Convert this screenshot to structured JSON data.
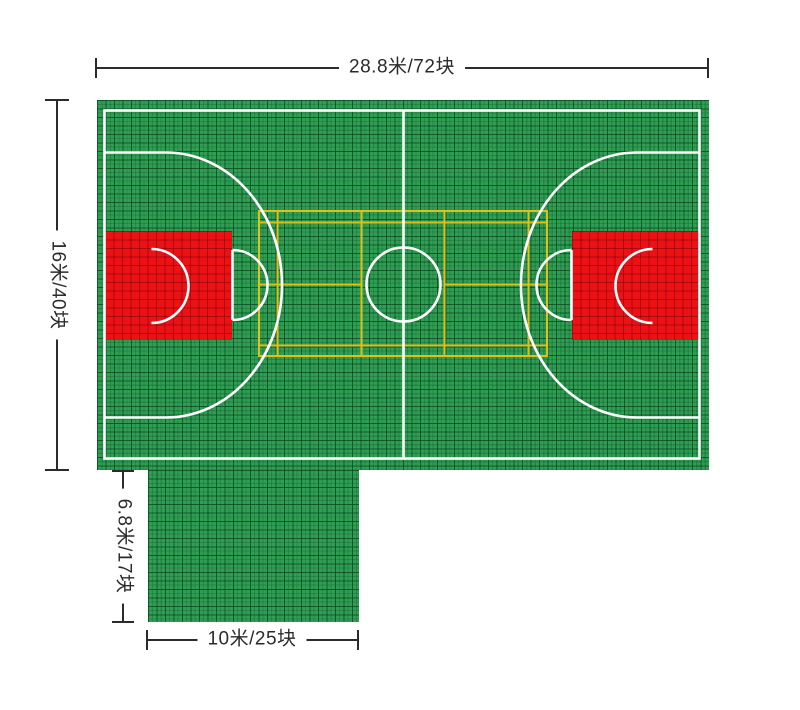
{
  "diagram": {
    "labels": {
      "top_width": "28.8米/72块",
      "left_height": "16米/40块",
      "extension_height": "6.8米/17块",
      "extension_width": "10米/25块"
    },
    "colors": {
      "background": "#FFFFFF",
      "court_green": "#2F9E53",
      "key_red": "#EC1115",
      "marking_white": "#FFFFFF",
      "badminton_yellow": "#E2BE18",
      "dimension_line": "#2B2B2B"
    }
  }
}
